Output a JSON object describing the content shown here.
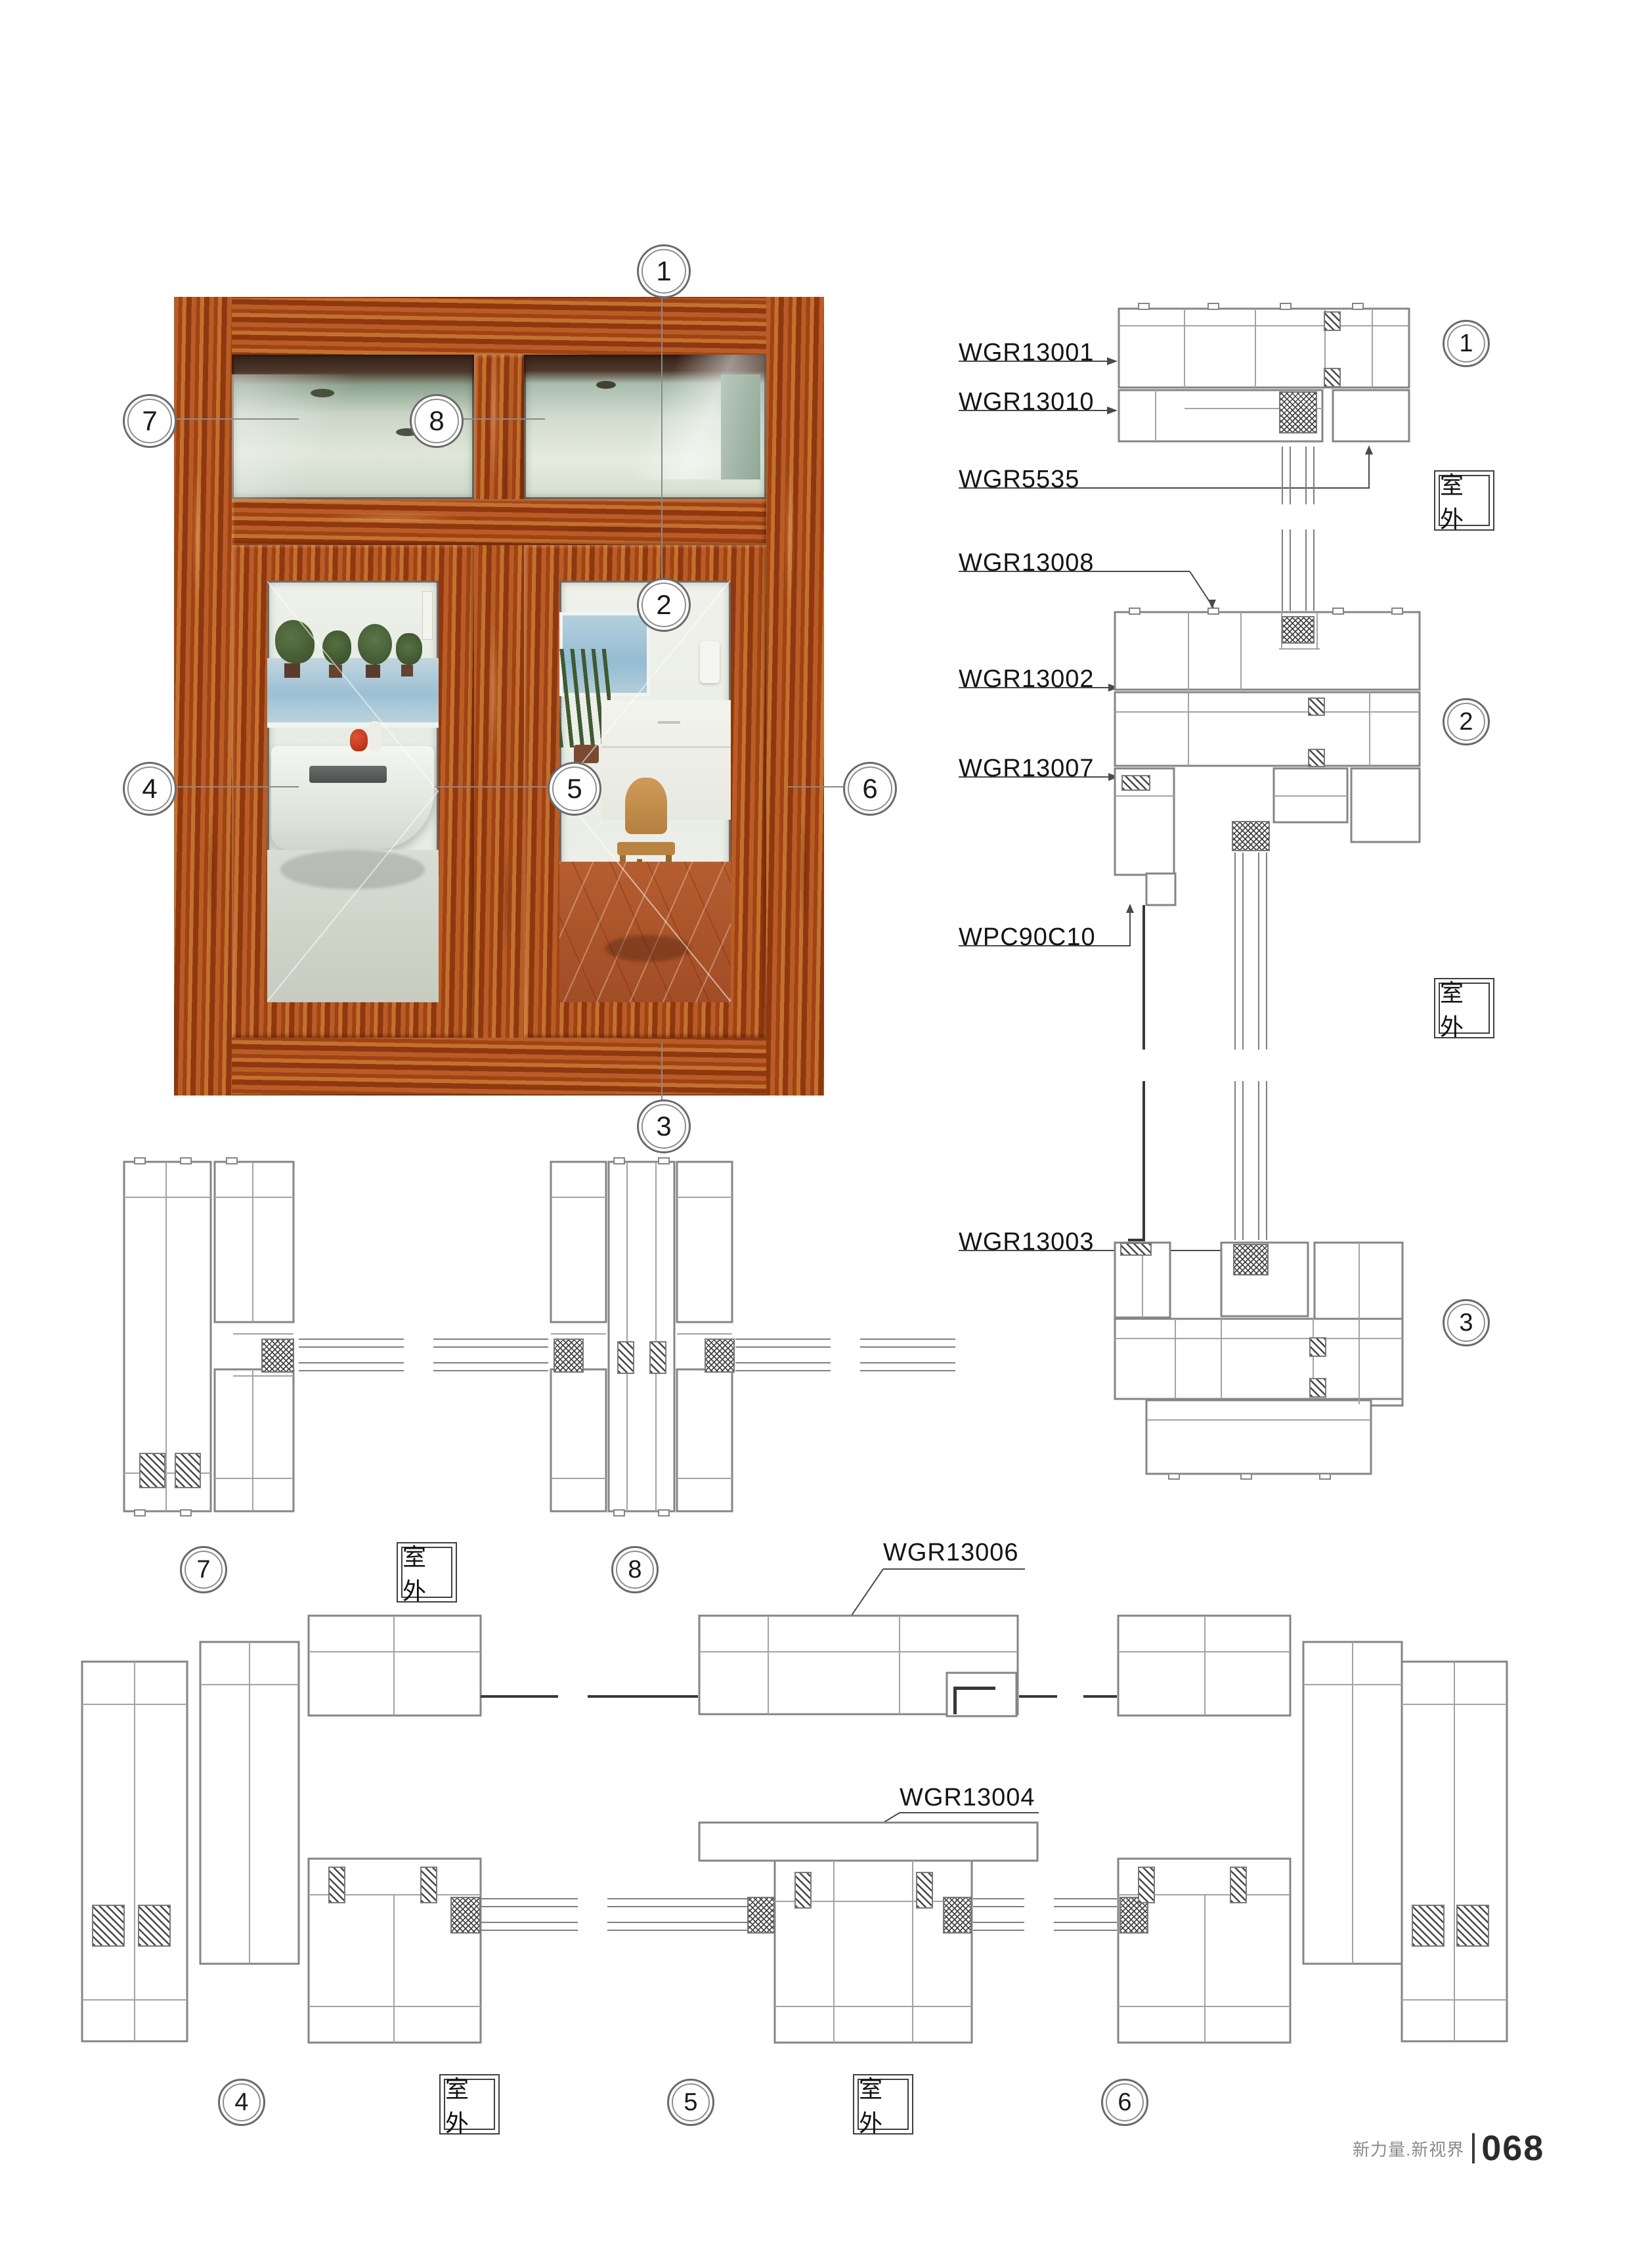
{
  "document": {
    "footer": {
      "tagline": "新力量.新视界",
      "page_number": "068"
    },
    "outdoor_label": "室外"
  },
  "callouts": {
    "c1": "1",
    "c2": "2",
    "c3": "3",
    "c4": "4",
    "c5": "5",
    "c6": "6",
    "c7": "7",
    "c8": "8"
  },
  "part_labels": {
    "wgr13001": "WGR13001",
    "wgr13010": "WGR13010",
    "wgr5535": "WGR5535",
    "wgr13008": "WGR13008",
    "wgr13002": "WGR13002",
    "wgr13007": "WGR13007",
    "wpc90c10": "WPC90C10",
    "wgr13003": "WGR13003",
    "wgr13006": "WGR13006",
    "wgr13004": "WGR13004"
  },
  "colors": {
    "wood": "#a8441a",
    "drawing_line": "#8a8a8a",
    "hatch": "#3f3f3f",
    "text": "#1a1a1a"
  }
}
